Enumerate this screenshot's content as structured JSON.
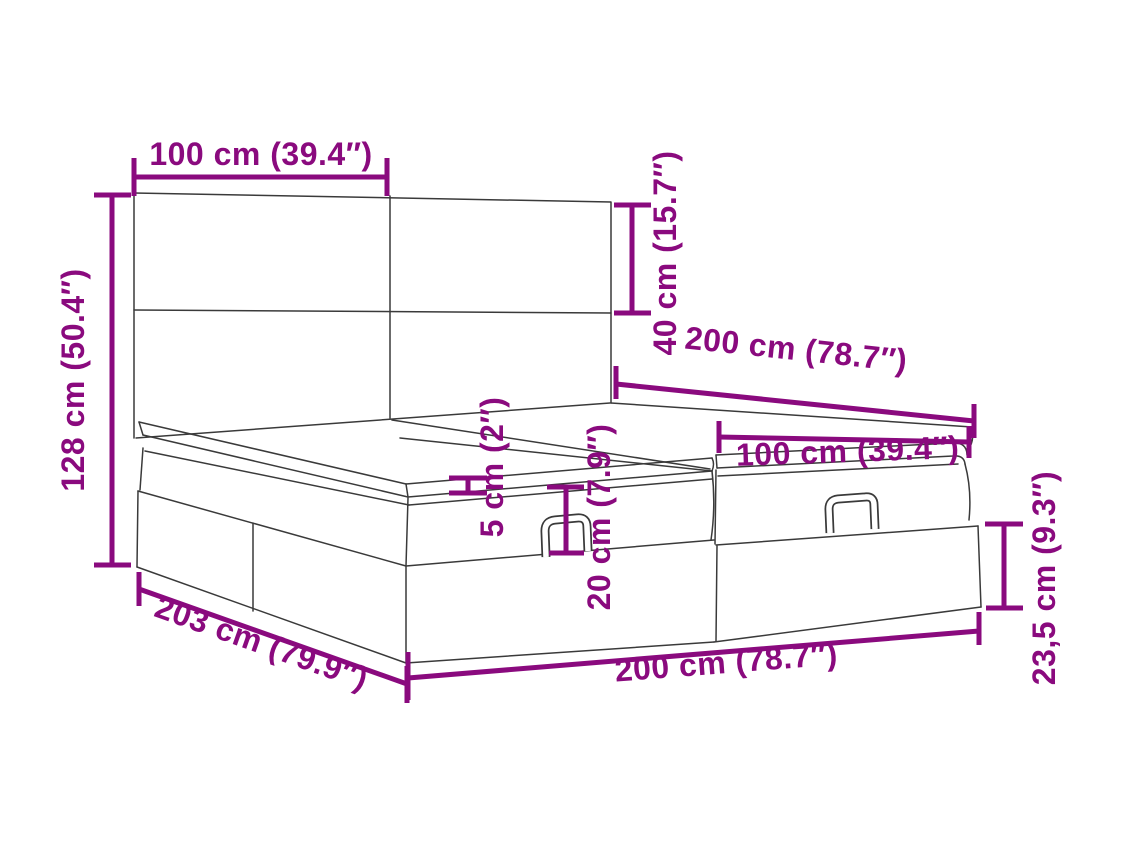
{
  "figure": {
    "title": "Ottoman bed with headboard - dimension diagram",
    "background": "#ffffff"
  },
  "colors": {
    "dimension": "#8A0A7E",
    "outline": "#3A3A3A"
  },
  "labels": {
    "headboard_panel_width": "100 cm (39.4″)",
    "overall_height": "128 cm (50.4″)",
    "headboard_panel_height": "40 cm (15.7″)",
    "bed_width_back": "200 cm (78.7″)",
    "mattress_half_width": "100 cm (39.4″)",
    "topper_thickness": "5 cm (2″)",
    "mattress_height": "20 cm (7.9″)",
    "base_height": "23,5 cm (9.3″)",
    "overall_length": "203 cm (79.9″)",
    "base_length": "200 cm (78.7″)"
  }
}
